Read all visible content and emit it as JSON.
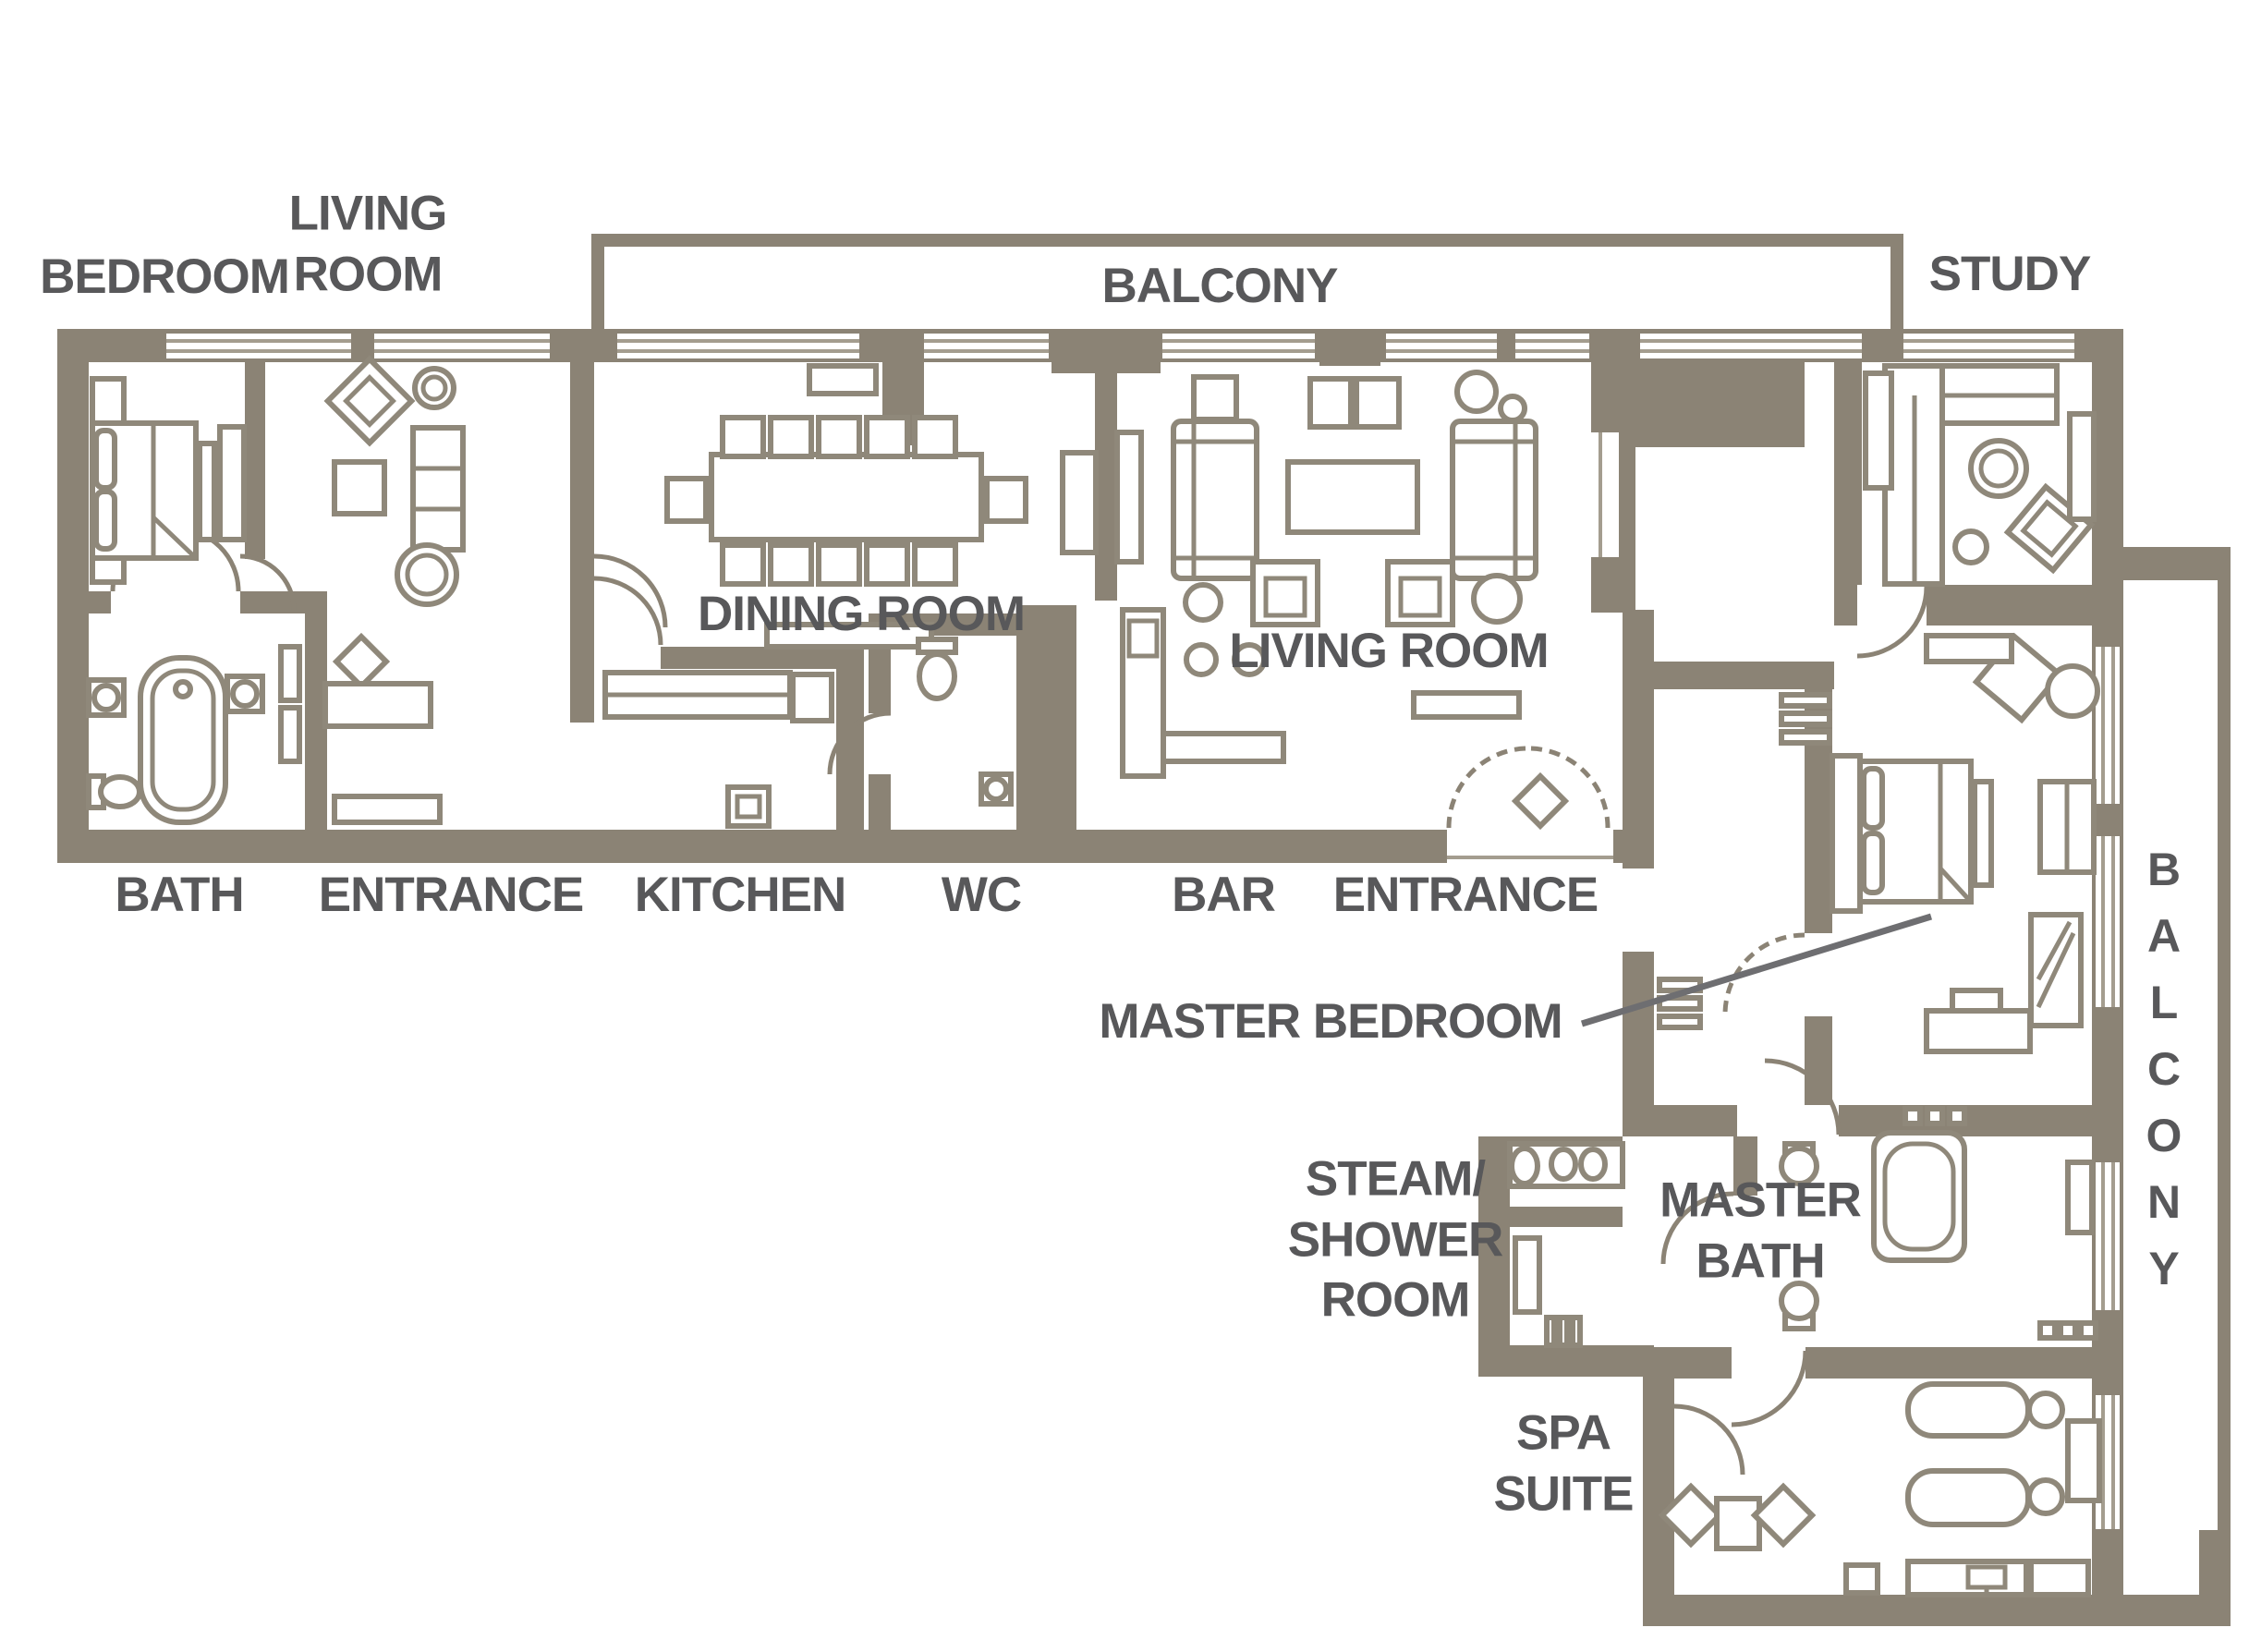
{
  "floor_plan": {
    "type": "residential-suite-floor-plan",
    "colors": {
      "wall": "#8b8375",
      "furniture_line": "#8f887a",
      "label_text": "#58585a",
      "background": "#ffffff"
    },
    "labels": {
      "bedroom": "BEDROOM",
      "living_room_left": {
        "line1": "LIVING",
        "line2": "ROOM"
      },
      "balcony_top": "BALCONY",
      "study": "STUDY",
      "dining_room": "DINING ROOM",
      "living_room_center": "LIVING ROOM",
      "bath": "BATH",
      "entrance_left": "ENTRANCE",
      "kitchen": "KITCHEN",
      "wc": "WC",
      "bar": "BAR",
      "entrance_right": "ENTRANCE",
      "master_bedroom": "MASTER BEDROOM",
      "steam_shower_room": {
        "line1": "STEAM/",
        "line2": "SHOWER",
        "line3": "ROOM"
      },
      "master_bath": {
        "line1": "MASTER",
        "line2": "BATH"
      },
      "spa_suite": {
        "line1": "SPA",
        "line2": "SUITE"
      },
      "balcony_right": "BALCONY"
    }
  }
}
